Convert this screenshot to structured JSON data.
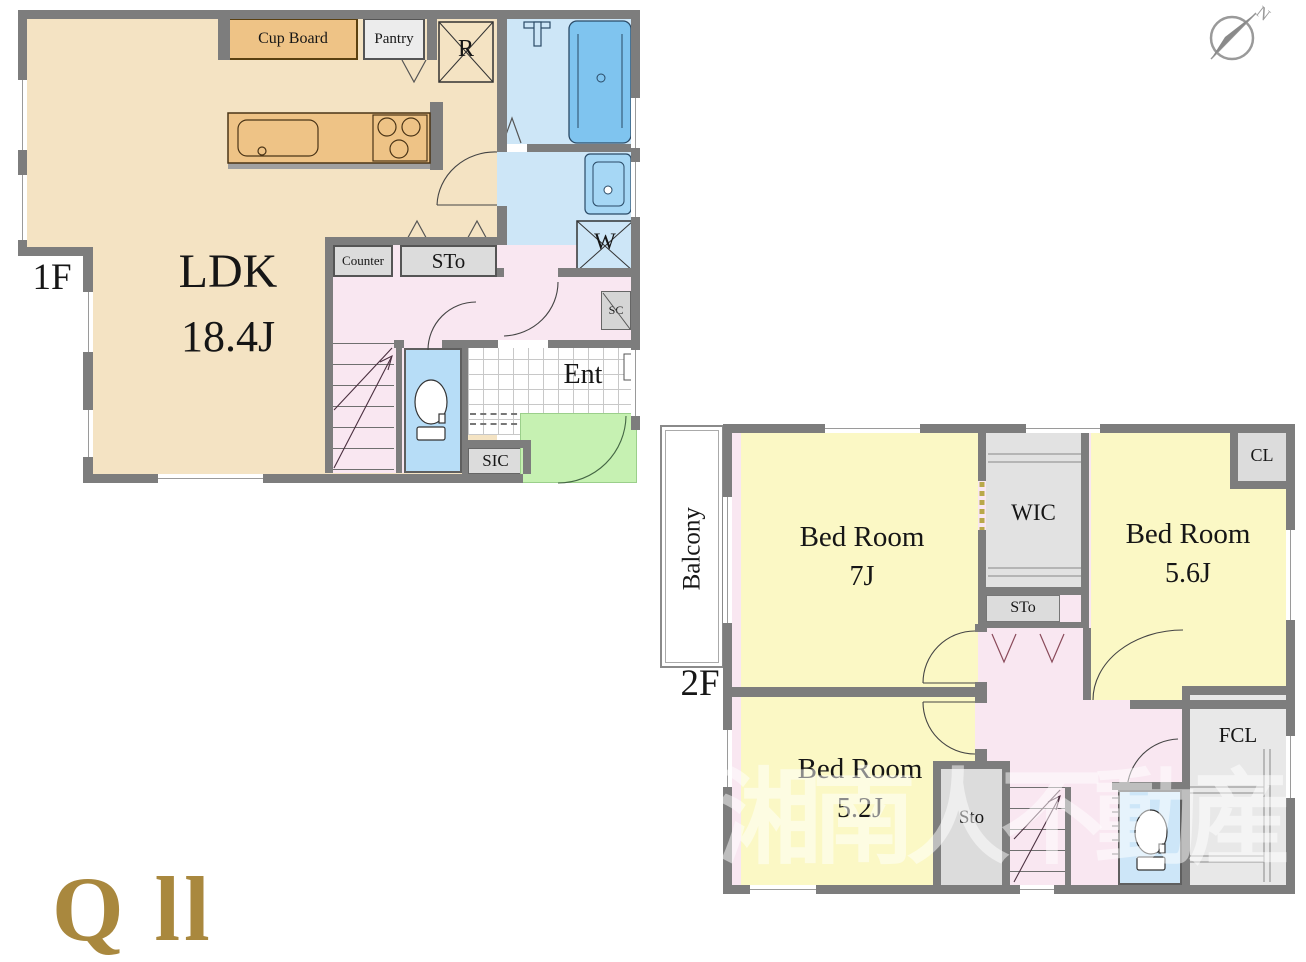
{
  "floor1": {
    "label": "1F",
    "ldk": {
      "name": "LDK",
      "size": "18.4J"
    },
    "cup_board": "Cup Board",
    "pantry": "Pantry",
    "refrigerator": "R",
    "counter": "Counter",
    "storage": "STo",
    "shoe_closet": "SC",
    "entrance": "Ent",
    "shoe_in_closet": "SIC",
    "washing_machine": "W"
  },
  "floor2": {
    "label": "2F",
    "balcony": "Balcony",
    "bedroom_main": {
      "name": "Bed Room",
      "size": "7J"
    },
    "bedroom_second": {
      "name": "Bed Room",
      "size": "5.6J"
    },
    "bedroom_third": {
      "name": "Bed Room",
      "size": "5.2J"
    },
    "walk_in_closet": "WIC",
    "closet": "CL",
    "storage_upper": "STo",
    "storage_lower": "Sto",
    "futon_closet": "FCL"
  },
  "compass": {
    "north": "N"
  },
  "watermark": {
    "text": "湘南人不動産"
  },
  "logo": {
    "partial_text": "Q ll"
  },
  "colors": {
    "wall_gray": "#7d7d7d",
    "ldk_floor": "#f4e3c3",
    "kitchen_wood": "#eec386",
    "bath_floor": "#cde6f7",
    "tub_blue": "#7fc4ef",
    "vanity_blue": "#a6d7f5",
    "toilet_floor": "#b7ddf7",
    "hall_pink": "#f9e7f1",
    "storage_gray": "#dcdcdc",
    "porch_green": "#c6f1b2",
    "bedroom_yellow": "#fbf8c5",
    "watermark_white": "rgba(255,255,255,0.5)",
    "logo_gold": "#a9883e",
    "compass_gray": "#999999"
  }
}
